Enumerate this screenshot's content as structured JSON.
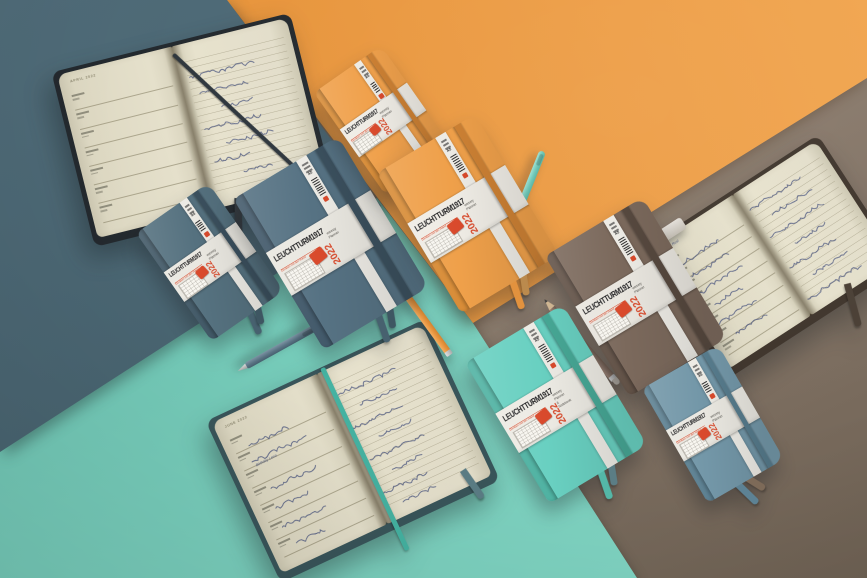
{
  "scene": {
    "description": "Flat-lay product photo of LEUCHTTURM1917 2022 weekly planners in slate blue, apricot orange, warm earth brown, mint green and stone blue, arranged on matching colour-block paper backgrounds with pens and pencils",
    "width": 867,
    "height": 578
  },
  "brand": {
    "name": "LEUCHTTURM1917",
    "slogan": "Denken mit der Hand",
    "year": "2022",
    "logo_color": "#d94a2c"
  },
  "background_sheets": [
    {
      "name": "slate",
      "color": "#48626e"
    },
    {
      "name": "orange",
      "color": "#e9993f"
    },
    {
      "name": "mint",
      "color": "#74cab8"
    },
    {
      "name": "brown",
      "color": "#8a7a6c"
    }
  ],
  "closed_notebooks": [
    {
      "id": "slate-pocket",
      "size": "A6",
      "variant": "Weekly Planner",
      "cover": "#55717f",
      "spine": "#415866",
      "elastic": "#3b505e",
      "band": "#eae8e1",
      "ribbons": [
        "#47616f",
        "#3e5662"
      ]
    },
    {
      "id": "slate-medium",
      "size": "A5",
      "variant": "Weekly Planner",
      "cover": "#567283",
      "spine": "#42596a",
      "elastic": "#3b505e",
      "band": "#eae8e1",
      "ribbons": [
        "#47616f",
        "#3e5662"
      ]
    },
    {
      "id": "orange-pocket",
      "size": "A6",
      "variant": "Weekly Planner",
      "cover": "#f0a14c",
      "spine": "#d88c37",
      "elastic": "#cd8134",
      "band": "#efece5",
      "ribbons": [
        "#e2923e",
        "#c89a5e"
      ]
    },
    {
      "id": "orange-medium",
      "size": "A5",
      "variant": "Weekly Planner",
      "cover": "#efa04a",
      "spine": "#d88c37",
      "elastic": "#cd8134",
      "band": "#efece5",
      "ribbons": [
        "#e2923e",
        "#bb8a4d"
      ]
    },
    {
      "id": "brown-medium",
      "size": "A5",
      "variant": "Weekly Planner",
      "cover": "#7b695c",
      "spine": "#615146",
      "elastic": "#57493f",
      "band": "#e9e6df",
      "ribbons": [
        "#5f5146",
        "#4e4238"
      ]
    },
    {
      "id": "mint-medium",
      "size": "A5",
      "variant": "Weekly Planner & Notebook",
      "cover": "#69d0c1",
      "spine": "#4fb2a2",
      "elastic": "#47a896",
      "band": "#edebe4",
      "ribbons": [
        "#54b7a7",
        "#5b7d85"
      ]
    },
    {
      "id": "stone-blue-pocket",
      "size": "A6",
      "variant": "Weekly Planner",
      "cover": "#7397a8",
      "spine": "#5d8192",
      "elastic": "#577c8d",
      "band": "#eae8e1",
      "ribbons": [
        "#5d8294",
        "#7d6a58"
      ]
    }
  ],
  "open_notebooks": [
    {
      "id": "april-planner",
      "header": "APRIL 2022",
      "left_page": "weekly schedule rows",
      "right_page": "handwritten appointments (mostly illegible)",
      "elastic": "#2e363d",
      "cover": "#23292e",
      "page": "#ded9c3"
    },
    {
      "id": "june-planner",
      "header": "JUNE 2022",
      "legible_fragment": "Birthday Lena",
      "left_page": "weekly schedule rows with handwriting",
      "right_page": "handwritten notes (mostly illegible)",
      "elastic": "#45b3a2",
      "cover": "#39555a",
      "page": "#ded9c3"
    },
    {
      "id": "moving-notes",
      "header": "",
      "legible_fragment": "Café Rosi",
      "left_page": "handwritten schedule (mostly illegible)",
      "right_page": "handwritten moving to-do list (mostly illegible)",
      "elastic": "#4a3f35",
      "cover": "#3f352c",
      "page": "#ded9c3"
    }
  ],
  "stationery": [
    {
      "id": "teal-pen",
      "color": "#74cdbc"
    },
    {
      "id": "slate-pen",
      "color": "#5b7485"
    },
    {
      "id": "orange-pencil",
      "color": "#e9953d"
    },
    {
      "id": "brown-pencil",
      "color": "#8a7365"
    },
    {
      "id": "gray-eraser",
      "color": "#d8d4cf"
    },
    {
      "id": "slate-pen-cap",
      "color": "#4f6b7a"
    }
  ],
  "palette": {
    "ink": "#3d4a78",
    "page_line": "#7d7659",
    "label_paper": "#eae8e1"
  }
}
